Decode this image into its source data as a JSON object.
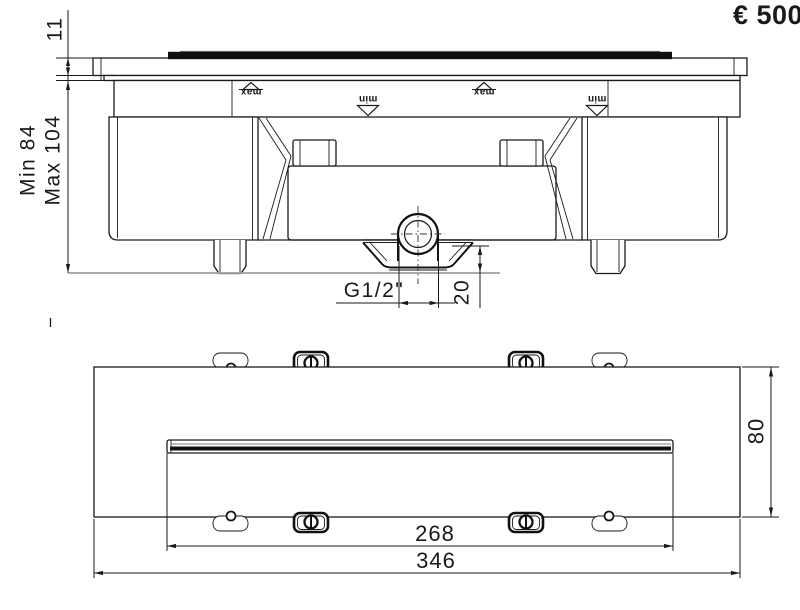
{
  "price_label": "€ 500",
  "section_view": {
    "plate_thickness_label": "11",
    "depth_min_label": "Min 84",
    "depth_max_label": "Max 104",
    "water_max_marker": "max",
    "water_min_marker": "min",
    "connection_thread_label": "G1/2\"",
    "outlet_depth_label": "20"
  },
  "plan_view": {
    "slot_length_label": "268",
    "overall_length_label": "346",
    "body_depth_label": "80"
  },
  "colors": {
    "line": "#1a1a1a",
    "light_line": "#9e9e9e",
    "slot_black": "#101010",
    "price_text": "#15151c"
  }
}
